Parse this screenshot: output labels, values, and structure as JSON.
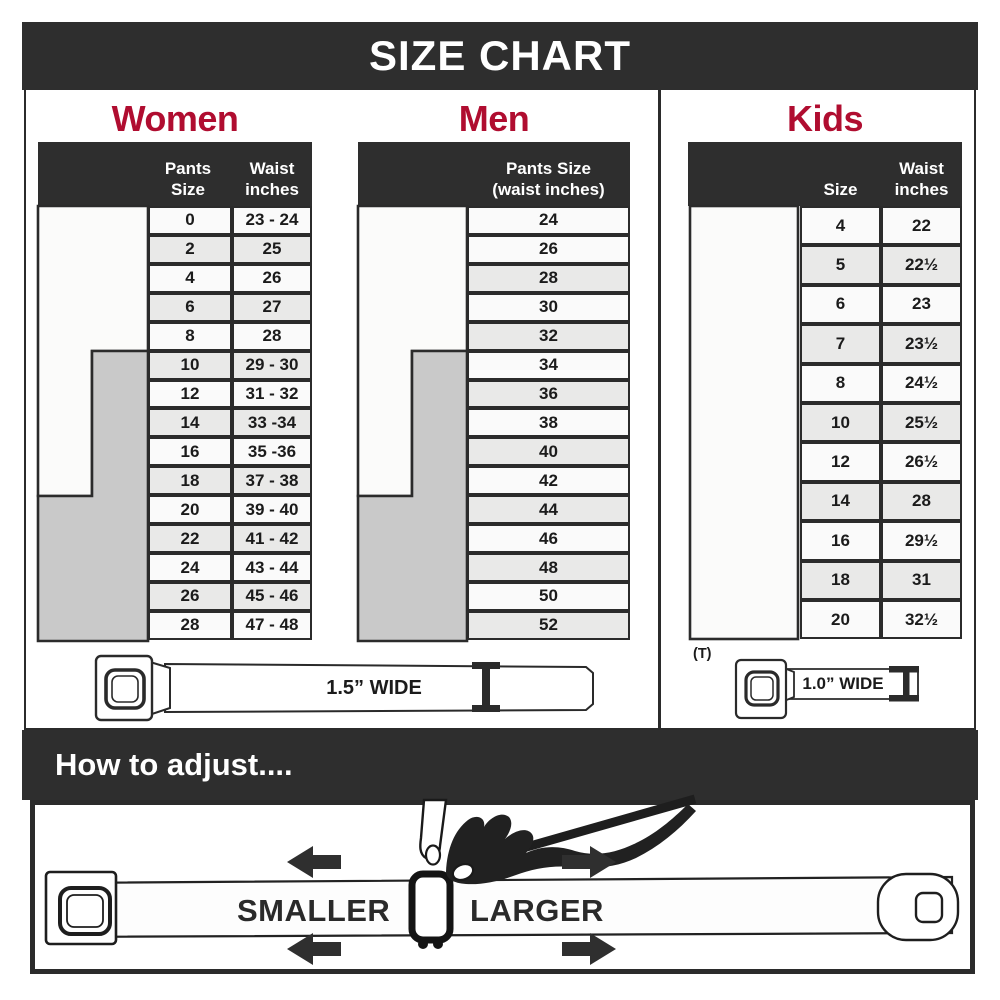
{
  "title": "SIZE CHART",
  "colors": {
    "accent": "#b00d30",
    "dark_band": "#2e2e2e",
    "xlarge_gray": "#c9c9c9"
  },
  "sections": {
    "women": {
      "label": "Women",
      "header": {
        "col1": "Pants Size",
        "col2": "Waist\ninches"
      },
      "size_groups": {
        "regular": "REGULAR SIZE",
        "xlarge": "X-LARGE"
      },
      "rows": [
        {
          "size": "0",
          "waist": "23 - 24"
        },
        {
          "size": "2",
          "waist": "25"
        },
        {
          "size": "4",
          "waist": "26"
        },
        {
          "size": "6",
          "waist": "27"
        },
        {
          "size": "8",
          "waist": "28"
        },
        {
          "size": "10",
          "waist": "29 - 30"
        },
        {
          "size": "12",
          "waist": "31 - 32"
        },
        {
          "size": "14",
          "waist": "33 -34"
        },
        {
          "size": "16",
          "waist": "35 -36"
        },
        {
          "size": "18",
          "waist": "37 - 38"
        },
        {
          "size": "20",
          "waist": "39 - 40"
        },
        {
          "size": "22",
          "waist": "41 - 42"
        },
        {
          "size": "24",
          "waist": "43 - 44"
        },
        {
          "size": "26",
          "waist": "45 - 46"
        },
        {
          "size": "28",
          "waist": "47 - 48"
        }
      ]
    },
    "men": {
      "label": "Men",
      "header": "Pants Size\n(waist inches)",
      "size_groups": {
        "regular": "REGULAR SIZE",
        "xlarge": "X-LARGE"
      },
      "rows": [
        "24",
        "26",
        "28",
        "30",
        "32",
        "34",
        "36",
        "38",
        "40",
        "42",
        "44",
        "46",
        "48",
        "50",
        "52"
      ]
    },
    "kids": {
      "label": "Kids",
      "header": {
        "col1": "Size",
        "col2": "Waist\ninches"
      },
      "size_group": "KIDS SIZE",
      "note": "Note:\nNot intended for\nToddler Sizes (T)",
      "rows": [
        {
          "size": "4",
          "waist": "22"
        },
        {
          "size": "5",
          "waist": "22½"
        },
        {
          "size": "6",
          "waist": "23"
        },
        {
          "size": "7",
          "waist": "23½"
        },
        {
          "size": "8",
          "waist": "24½"
        },
        {
          "size": "10",
          "waist": "25½"
        },
        {
          "size": "12",
          "waist": "26½"
        },
        {
          "size": "14",
          "waist": "28"
        },
        {
          "size": "16",
          "waist": "29½"
        },
        {
          "size": "18",
          "waist": "31"
        },
        {
          "size": "20",
          "waist": "32½"
        }
      ]
    }
  },
  "belts": {
    "adult_width_label": "1.5” WIDE",
    "kids_width_label": "1.0” WIDE"
  },
  "how_to_adjust": {
    "heading": "How to adjust....",
    "smaller": "SMALLER",
    "larger": "LARGER"
  }
}
